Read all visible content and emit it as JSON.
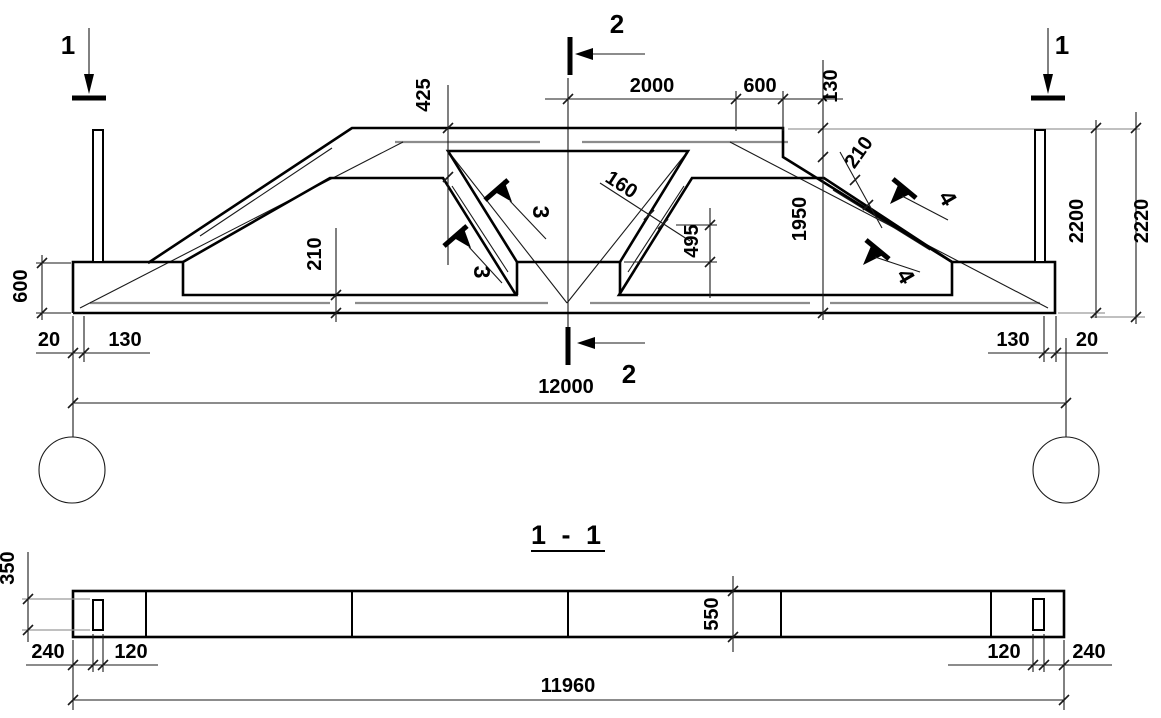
{
  "markers": {
    "s1": "1",
    "s2": "2",
    "s3": "3",
    "s4": "4"
  },
  "elevation": {
    "dim_425": "425",
    "dim_2000": "2000",
    "dim_600_top": "600",
    "dim_130_top": "130",
    "dim_210_slope": "210",
    "dim_160": "160",
    "dim_1950": "1950",
    "dim_2200": "2200",
    "dim_2220": "2220",
    "dim_495": "495",
    "dim_210_bottom": "210",
    "dim_600_left": "600",
    "dim_20_left": "20",
    "dim_130_left": "130",
    "dim_12000": "12000",
    "dim_130_right": "130",
    "dim_20_right": "20"
  },
  "section_view": {
    "title": "1 - 1",
    "dim_350": "350",
    "dim_240_left": "240",
    "dim_120_left": "120",
    "dim_550": "550",
    "dim_120_right": "120",
    "dim_240_right": "240",
    "dim_11960": "11960"
  }
}
